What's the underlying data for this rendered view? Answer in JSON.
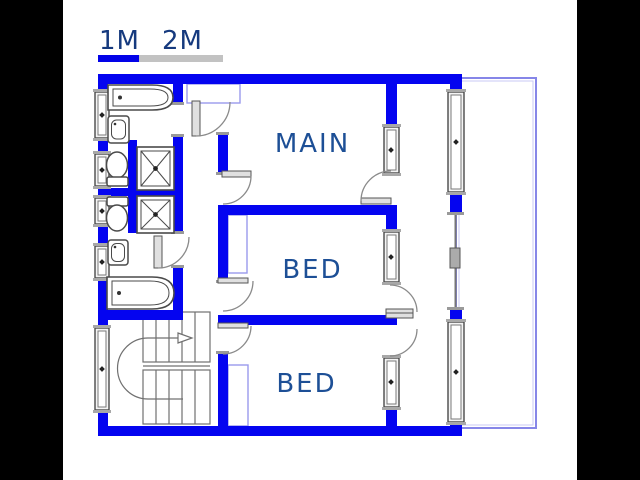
{
  "plan": {
    "title": "floor-plan",
    "scale_bar": {
      "labels": [
        "1M",
        "2M"
      ],
      "segment_colors": [
        "#0202e8",
        "#c2c2c2"
      ]
    },
    "rooms": [
      {
        "label": "MAIN"
      },
      {
        "label": "BED"
      },
      {
        "label": "BED"
      }
    ],
    "fixtures": [
      "bathtub",
      "sink",
      "toilet",
      "shower",
      "shower",
      "toilet",
      "sink",
      "bathtub",
      "staircase"
    ],
    "colors": {
      "wall": "#0404f0",
      "room_label_text": "#1d4f96",
      "scale_label_text": "#163a7e",
      "balcony_outline": "#8686e8",
      "fixture_line": "#4a4a4a",
      "background": "#000000",
      "paper": "#ffffff"
    }
  }
}
